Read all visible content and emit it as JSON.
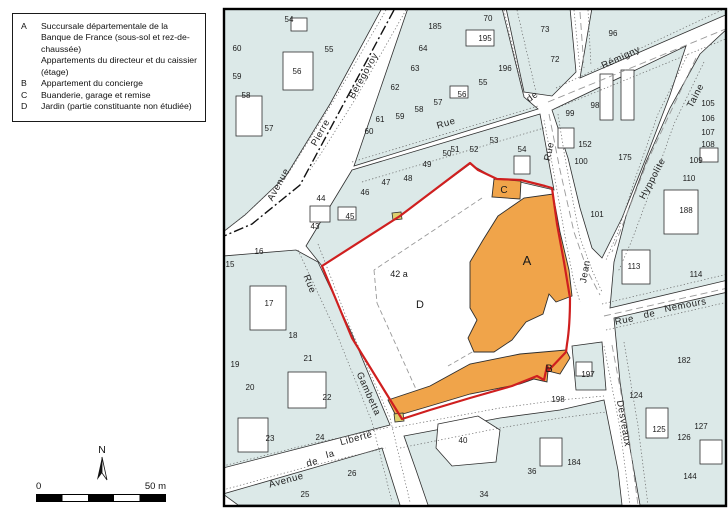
{
  "legend": {
    "items": [
      {
        "key": "A",
        "text": "Succursale départementale de la Banque de France (sous-sol et rez-de-chaussée)"
      },
      {
        "key": "",
        "text": "Appartements du directeur et du caissier (étage)"
      },
      {
        "key": "B",
        "text": "Appartement du concierge"
      },
      {
        "key": "C",
        "text": "Buanderie, garage et remise"
      },
      {
        "key": "D",
        "text": "Jardin (partie constituante non étudiée)"
      }
    ]
  },
  "compass": {
    "label": "N"
  },
  "scalebar": {
    "zero": "0",
    "max": "50 m"
  },
  "map": {
    "colors": {
      "parcel": "#dce9e8",
      "line": "#2e2e2e",
      "building": "#ffffff",
      "highlight": "#f0a44a",
      "boundary": "#cf1f1f",
      "marker": "#ddd06e",
      "dash": "#999999",
      "dot": "#666666",
      "frame": "#000000"
    },
    "blocks": [
      "223,8 382,8 330,104 286,176 245,215 223,232",
      "408,8 502,8 524,97 538,109 354,166",
      "506,8 570,8 576,72 552,96 524,92",
      "592,8 728,8 728,14 580,78",
      "552,110 686,46 670,95 646,158 622,218 602,258 592,248 580,208 568,158 556,122",
      "700,54 728,28 728,280 610,308 614,262 626,216 646,162 670,108",
      "614,318 728,292 728,505 640,505 630,448 620,382",
      "404,436 500,418 560,410 604,400 618,470 622,505 428,505 416,470",
      "223,256 296,250 318,262 352,334 390,425 223,468",
      "223,494 382,448 400,505 238,505",
      "352,170 540,114 554,190 520,182 498,180 470,164 400,216 322,266 306,246",
      "572,346 602,342 606,390 576,390"
    ],
    "buildings": [
      {
        "r": [
          283,
          52,
          30,
          38
        ]
      },
      {
        "r": [
          236,
          96,
          26,
          40
        ]
      },
      {
        "r": [
          291,
          18,
          16,
          13
        ]
      },
      {
        "r": [
          466,
          30,
          28,
          16
        ]
      },
      {
        "r": [
          450,
          86,
          18,
          12
        ]
      },
      {
        "r": [
          600,
          74,
          13,
          46
        ]
      },
      {
        "r": [
          621,
          70,
          13,
          50
        ]
      },
      {
        "r": [
          558,
          128,
          16,
          20
        ]
      },
      {
        "r": [
          664,
          190,
          34,
          44
        ]
      },
      {
        "r": [
          700,
          148,
          18,
          14
        ]
      },
      {
        "r": [
          622,
          250,
          28,
          34
        ]
      },
      {
        "r": [
          646,
          408,
          22,
          30
        ]
      },
      {
        "r": [
          700,
          440,
          22,
          24
        ]
      },
      {
        "r": [
          540,
          438,
          22,
          28
        ]
      },
      {
        "r": [
          250,
          286,
          36,
          44
        ]
      },
      {
        "r": [
          288,
          372,
          38,
          36
        ]
      },
      {
        "r": [
          238,
          418,
          30,
          34
        ]
      },
      {
        "r": [
          310,
          206,
          20,
          16
        ]
      },
      {
        "r": [
          338,
          207,
          18,
          13
        ]
      },
      {
        "r": [
          514,
          156,
          16,
          18
        ]
      },
      {
        "r": [
          576,
          362,
          16,
          14
        ]
      },
      {
        "p": "438,424 478,416 500,430 496,462 452,466 436,448"
      }
    ],
    "dots": [
      "M386,10 L334,100 L288,174 L248,212 L226,230",
      "M406,10 L356,98 L322,152 L310,170",
      "M352,162 L538,106",
      "M362,182 L544,128",
      "M544,120 L550,152 L558,196 L566,242 L574,282 L580,302",
      "M558,114 L564,152 L572,196 L580,238 L592,270 L602,292",
      "M556,88 L722,10",
      "M552,110 L728,38",
      "M504,10 L524,96",
      "M517,10 L536,92",
      "M574,10 L580,70",
      "M588,10 L591,66",
      "M688,54 L658,114 L636,176 L618,232 L606,260",
      "M704,62 L674,124 L652,186 L632,240 L618,272",
      "M602,304 L728,274",
      "M606,330 L728,302",
      "M604,346 L620,428 L630,505",
      "M624,342 L638,426 L648,505",
      "M298,250 L336,332 L372,422 L392,502",
      "M318,244 L352,332 L390,418 L410,502",
      "M223,466 L310,444 L390,427",
      "M223,490 L310,466 L386,448",
      "M392,428 L500,408 L560,400 L604,396",
      "M400,448 L500,428 L560,418 L606,412"
    ],
    "axis": [
      "M394,10 L300,185 L252,224 L224,236"
    ],
    "dashes": [
      "M548,102 L728,28",
      "M696,58 L648,160 L612,252",
      "M549,114 L560,170 L574,232 L588,272 L600,295",
      "M604,316 L728,288",
      "M612,345 L628,430 L638,505",
      "M580,12 L584,68"
    ],
    "property_dashes": [
      "M482,198 L374,270",
      "M374,270 L377,303",
      "M377,303 L420,398",
      "M500,336 L448,366",
      "M540,234 L506,260"
    ],
    "orange": [
      "498,216 524,198 553,194 560,232 569,270 572,296 556,302 549,294 543,314 526,322 512,340 494,352 474,352 468,338 477,320 470,308 470,262 483,240",
      "388,400 430,386 470,364 520,354 566,350 570,358 560,374 548,371 547,382 534,379 520,384 470,394 430,406 396,416",
      "494,179 521,181 520,199 492,197"
    ],
    "markers": [
      "392,213 401,212 402,219 393,220",
      "394,414 403,413 404,421 395,422"
    ],
    "boundary": "M322,266 L400,216 L470,163 L478,170 L497,179 L521,180 L545,186 L552,188 L557,224 L564,262 L570,298 C570,318 569,332 567,344 L566,352 L549,370 L547,366 L544,380 L537,376 L512,386 L470,398 L430,410 L402,419 L352,338 Z",
    "street_labels": [
      {
        "t": "Avenue",
        "x": 281,
        "y": 186,
        "r": -61
      },
      {
        "t": "Pierre",
        "x": 323,
        "y": 134,
        "r": -61
      },
      {
        "t": "Bérégovoy",
        "x": 366,
        "y": 77,
        "r": -61
      },
      {
        "t": "Rue",
        "x": 447,
        "y": 126,
        "r": -17
      },
      {
        "t": "de",
        "x": 534,
        "y": 99,
        "r": -35
      },
      {
        "t": "Rue",
        "x": 552,
        "y": 152,
        "r": -78
      },
      {
        "t": "Jean",
        "x": 588,
        "y": 272,
        "r": -80
      },
      {
        "t": "Rémigny",
        "x": 622,
        "y": 60,
        "r": -25
      },
      {
        "t": "Taine",
        "x": 698,
        "y": 97,
        "r": -62
      },
      {
        "t": "Hyppolite",
        "x": 655,
        "y": 180,
        "r": -62
      },
      {
        "t": "Rue",
        "x": 625,
        "y": 323,
        "r": -11
      },
      {
        "t": "de",
        "x": 650,
        "y": 317,
        "r": -11
      },
      {
        "t": "Nemours",
        "x": 686,
        "y": 308,
        "r": -11
      },
      {
        "t": "Desveaux",
        "x": 621,
        "y": 424,
        "r": 80
      },
      {
        "t": "Rue",
        "x": 307,
        "y": 285,
        "r": 68
      },
      {
        "t": "Gambetta",
        "x": 366,
        "y": 395,
        "r": 66
      },
      {
        "t": "Avenue",
        "x": 287,
        "y": 483,
        "r": -15
      },
      {
        "t": "de",
        "x": 313,
        "y": 465,
        "r": -15
      },
      {
        "t": "la",
        "x": 331,
        "y": 457,
        "r": -15
      },
      {
        "t": "Liberté",
        "x": 357,
        "y": 441,
        "r": -15
      }
    ],
    "parcel_labels": [
      {
        "t": "54",
        "x": 289,
        "y": 22
      },
      {
        "t": "55",
        "x": 329,
        "y": 52
      },
      {
        "t": "56",
        "x": 297,
        "y": 74
      },
      {
        "t": "60",
        "x": 237,
        "y": 51
      },
      {
        "t": "59",
        "x": 237,
        "y": 79
      },
      {
        "t": "58",
        "x": 246,
        "y": 98
      },
      {
        "t": "57",
        "x": 269,
        "y": 131
      },
      {
        "t": "185",
        "x": 435,
        "y": 29
      },
      {
        "t": "70",
        "x": 488,
        "y": 21
      },
      {
        "t": "195",
        "x": 485,
        "y": 41
      },
      {
        "t": "64",
        "x": 423,
        "y": 51
      },
      {
        "t": "63",
        "x": 415,
        "y": 71
      },
      {
        "t": "196",
        "x": 505,
        "y": 71
      },
      {
        "t": "55",
        "x": 483,
        "y": 85
      },
      {
        "t": "62",
        "x": 395,
        "y": 90
      },
      {
        "t": "56",
        "x": 462,
        "y": 97
      },
      {
        "t": "57",
        "x": 438,
        "y": 105
      },
      {
        "t": "58",
        "x": 419,
        "y": 112
      },
      {
        "t": "59",
        "x": 400,
        "y": 119
      },
      {
        "t": "61",
        "x": 380,
        "y": 122
      },
      {
        "t": "60",
        "x": 369,
        "y": 134
      },
      {
        "t": "73",
        "x": 545,
        "y": 32
      },
      {
        "t": "72",
        "x": 555,
        "y": 62
      },
      {
        "t": "96",
        "x": 613,
        "y": 36
      },
      {
        "t": "98",
        "x": 595,
        "y": 108
      },
      {
        "t": "99",
        "x": 570,
        "y": 116
      },
      {
        "t": "152",
        "x": 585,
        "y": 147
      },
      {
        "t": "100",
        "x": 581,
        "y": 164
      },
      {
        "t": "175",
        "x": 625,
        "y": 160
      },
      {
        "t": "101",
        "x": 597,
        "y": 217
      },
      {
        "t": "105",
        "x": 708,
        "y": 106
      },
      {
        "t": "106",
        "x": 708,
        "y": 121
      },
      {
        "t": "107",
        "x": 708,
        "y": 135
      },
      {
        "t": "108",
        "x": 708,
        "y": 147
      },
      {
        "t": "109",
        "x": 696,
        "y": 163
      },
      {
        "t": "110",
        "x": 689,
        "y": 181
      },
      {
        "t": "188",
        "x": 686,
        "y": 213
      },
      {
        "t": "113",
        "x": 634,
        "y": 269
      },
      {
        "t": "114",
        "x": 696,
        "y": 277
      },
      {
        "t": "182",
        "x": 684,
        "y": 363
      },
      {
        "t": "124",
        "x": 636,
        "y": 398
      },
      {
        "t": "125",
        "x": 659,
        "y": 432
      },
      {
        "t": "126",
        "x": 684,
        "y": 440
      },
      {
        "t": "127",
        "x": 701,
        "y": 429
      },
      {
        "t": "144",
        "x": 690,
        "y": 479
      },
      {
        "t": "197",
        "x": 588,
        "y": 377
      },
      {
        "t": "198",
        "x": 558,
        "y": 402
      },
      {
        "t": "40",
        "x": 463,
        "y": 443
      },
      {
        "t": "36",
        "x": 532,
        "y": 474
      },
      {
        "t": "34",
        "x": 484,
        "y": 497
      },
      {
        "t": "184",
        "x": 574,
        "y": 465
      },
      {
        "t": "15",
        "x": 230,
        "y": 267
      },
      {
        "t": "16",
        "x": 259,
        "y": 254
      },
      {
        "t": "17",
        "x": 269,
        "y": 306
      },
      {
        "t": "18",
        "x": 293,
        "y": 338
      },
      {
        "t": "19",
        "x": 235,
        "y": 367
      },
      {
        "t": "20",
        "x": 250,
        "y": 390
      },
      {
        "t": "21",
        "x": 308,
        "y": 361
      },
      {
        "t": "22",
        "x": 327,
        "y": 400
      },
      {
        "t": "23",
        "x": 270,
        "y": 441
      },
      {
        "t": "24",
        "x": 320,
        "y": 440
      },
      {
        "t": "25",
        "x": 305,
        "y": 497
      },
      {
        "t": "26",
        "x": 352,
        "y": 476
      },
      {
        "t": "43",
        "x": 315,
        "y": 229
      },
      {
        "t": "44",
        "x": 321,
        "y": 201
      },
      {
        "t": "45",
        "x": 350,
        "y": 219
      },
      {
        "t": "46",
        "x": 365,
        "y": 195
      },
      {
        "t": "47",
        "x": 386,
        "y": 185
      },
      {
        "t": "48",
        "x": 408,
        "y": 181
      },
      {
        "t": "49",
        "x": 427,
        "y": 167
      },
      {
        "t": "50",
        "x": 447,
        "y": 156
      },
      {
        "t": "51",
        "x": 455,
        "y": 152
      },
      {
        "t": "52",
        "x": 474,
        "y": 152
      },
      {
        "t": "53",
        "x": 494,
        "y": 143
      },
      {
        "t": "54",
        "x": 522,
        "y": 152
      }
    ],
    "unit_labels": [
      {
        "t": "42 a",
        "x": 399,
        "y": 277,
        "s": 9
      },
      {
        "t": "D",
        "x": 420,
        "y": 308,
        "s": 11
      },
      {
        "t": "A",
        "x": 527,
        "y": 265,
        "s": 13
      },
      {
        "t": "B",
        "x": 549,
        "y": 372,
        "s": 11
      },
      {
        "t": "C",
        "x": 504,
        "y": 193,
        "s": 10
      }
    ]
  }
}
